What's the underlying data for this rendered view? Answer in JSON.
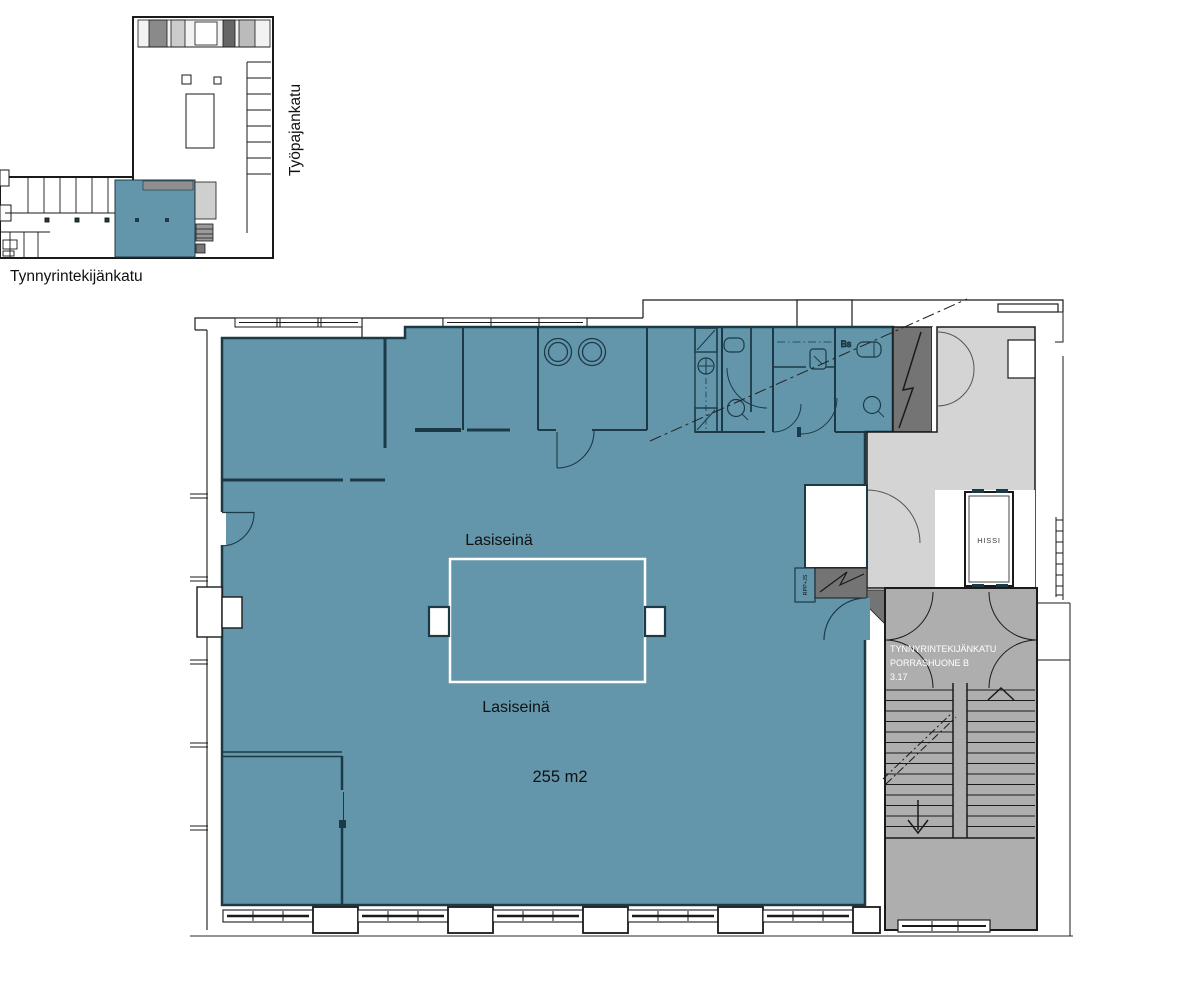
{
  "overview": {
    "street_vertical": "Työpajankatu",
    "street_horizontal": "Tynnyrintekijänkatu"
  },
  "plan": {
    "glass_wall_label_top": "Lasiseinä",
    "glass_wall_label_bottom": "Lasiseinä",
    "area_label": "255 m2",
    "elevator_label": "HISSI",
    "stairwell": {
      "line1": "TYNNYRINTEKIJÄNKATU",
      "line2": "PORRASHUONE B",
      "line3": "3.17"
    },
    "shaft_label": "RPP+JS",
    "fixture_label": "Bs"
  },
  "colors": {
    "highlight": "#6396AB",
    "lobby": "#D4D4D4",
    "stairwell": "#AEAEAE",
    "shaft": "#747474",
    "wall": "#1A1A1A",
    "iwall": "#1C3A46",
    "glass": "#FFFFFF",
    "text": "#111111",
    "stair_text": "#FFFFFF"
  }
}
